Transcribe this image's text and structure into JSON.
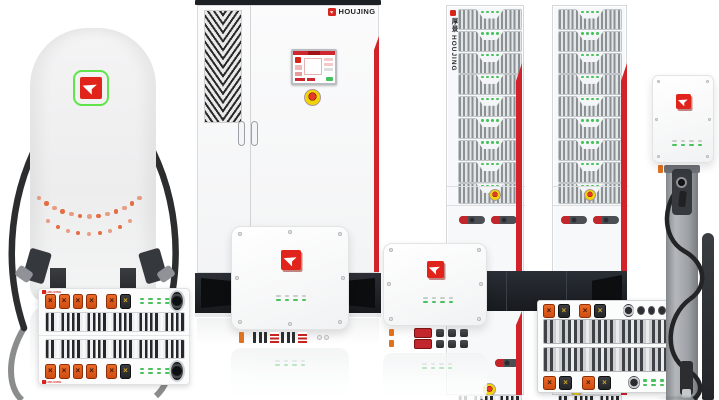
{
  "brand": {
    "name": "HOUJING",
    "name_cn": "厚景"
  },
  "palette": {
    "logo_red": "#e0241c",
    "logo_green_ring": "#5fe44a",
    "accent_red": "#d2232a",
    "connector_orange": "#e0641c",
    "led_green": "#49c15e",
    "estop_yellow": "#f2d406",
    "estop_red": "#d93226",
    "cable_black": "#2b2d2f",
    "panel_dark": "#23272c",
    "body_light": "#f6f7f8"
  },
  "icons": [
    "cursor-arrow-logo-icon",
    "emergency-stop-icon",
    "cooling-fan-icon",
    "charging-gun-icon",
    "ventilation-grille"
  ],
  "counts": {
    "rack_towers": 2,
    "rack_modules_per_tower": 9,
    "rack_module_leds": 4,
    "breakers_per_tower": 2,
    "wall_box_leds": 8,
    "module_unit_rows": 2,
    "pile_dot_arcs": 2
  }
}
